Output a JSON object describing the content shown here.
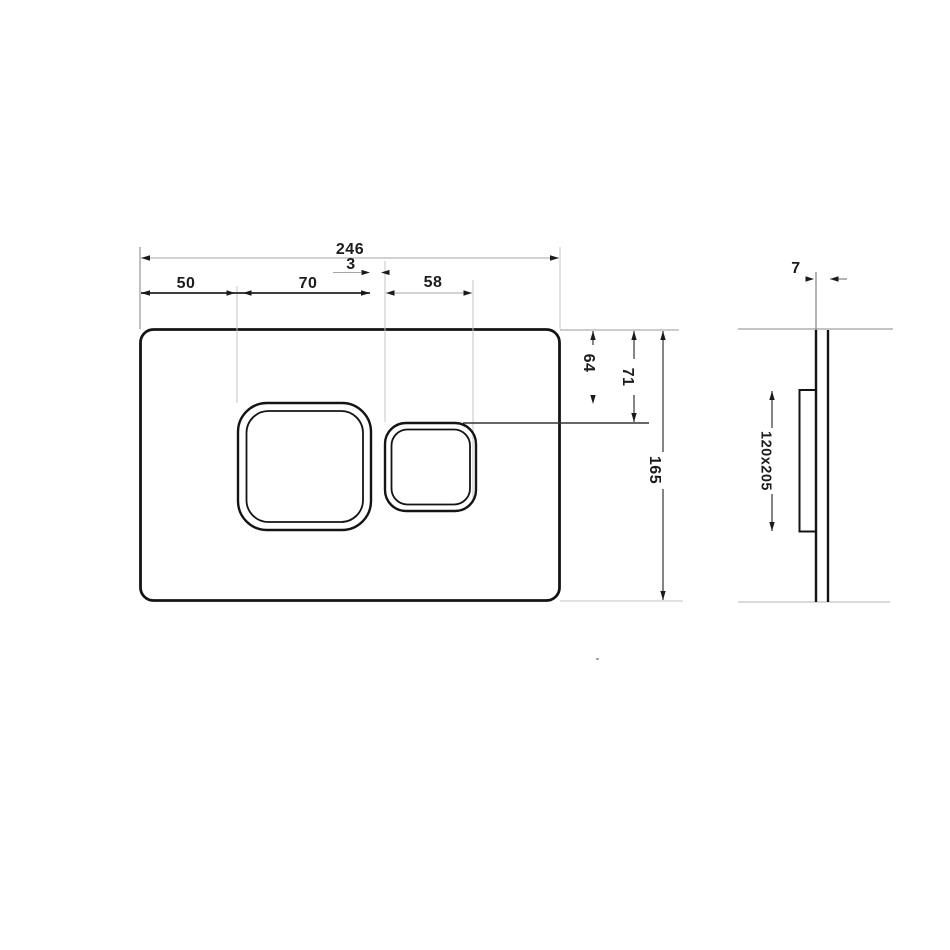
{
  "drawing": {
    "title": "flush-plate-dimension-drawing",
    "views": {
      "front": "plate with two rounded-square buttons",
      "side": "plate profile with rear mounting block"
    },
    "dimensions": {
      "front": {
        "total_width": "246",
        "spacing_3": "3",
        "offset_50": "50",
        "span_70": "70",
        "span_58": "58",
        "drop_64": "64",
        "drop_71": "71",
        "total_height": "165"
      },
      "side": {
        "thickness_7": "7",
        "cutout_120x205": "120x205"
      }
    },
    "colors": {
      "line_dark": "#141414",
      "dim_line": "#333333",
      "extension_line": "#c4c4c4",
      "light_dim": "#a6a6a6",
      "label_text": "#1c1c1c"
    }
  }
}
